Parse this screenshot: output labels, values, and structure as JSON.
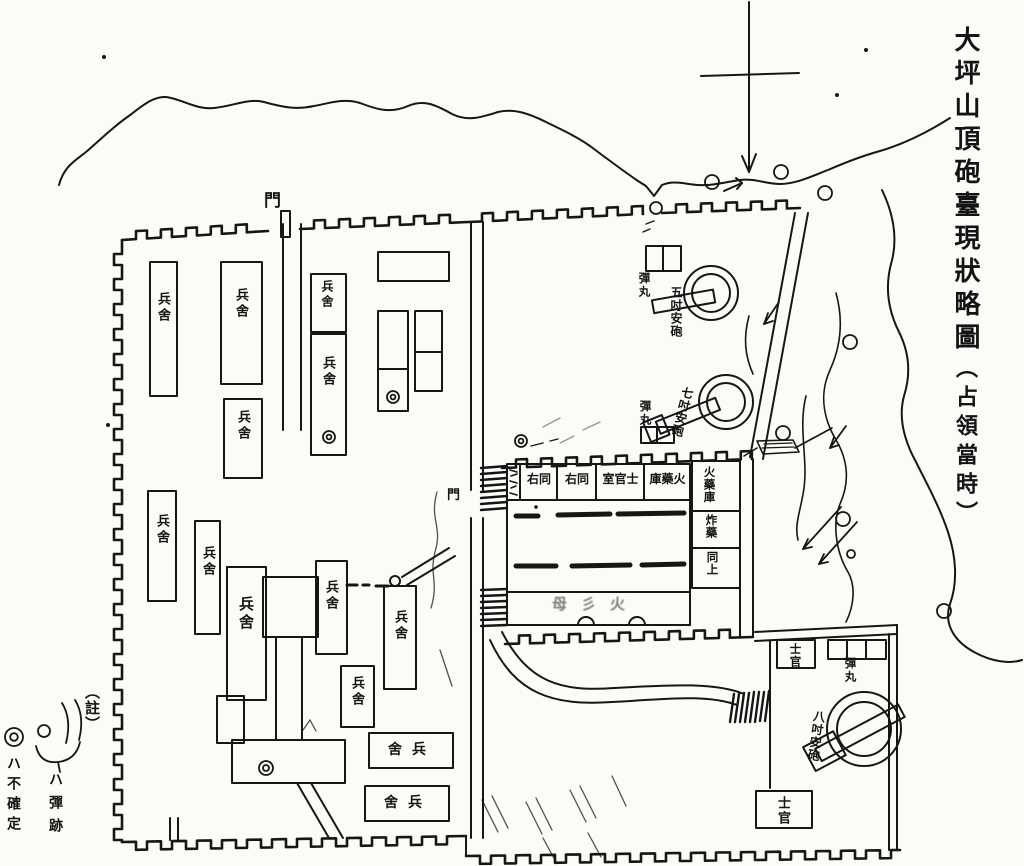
{
  "title": {
    "text": "大坪山頂砲臺現狀略圖",
    "subtitle": "（占領當時）"
  },
  "legend": {
    "heading": "（註）",
    "shell_trace": "ハ彈跡",
    "uncertain": "ハ不確定"
  },
  "labels": {
    "gate": "門",
    "barracks": "兵舍",
    "officer_room": "士官室",
    "ditto_right": "同右",
    "powder_magazine": "火藥庫",
    "explosives": "炸藥",
    "ditto_above": "同上",
    "shells": "彈丸",
    "gun_5inch": "五吋安砲",
    "gun_7inch": "七吋安砲",
    "gun_8inch": "八吋安砲",
    "officer": "士官",
    "faint_marks": "母彡火"
  }
}
